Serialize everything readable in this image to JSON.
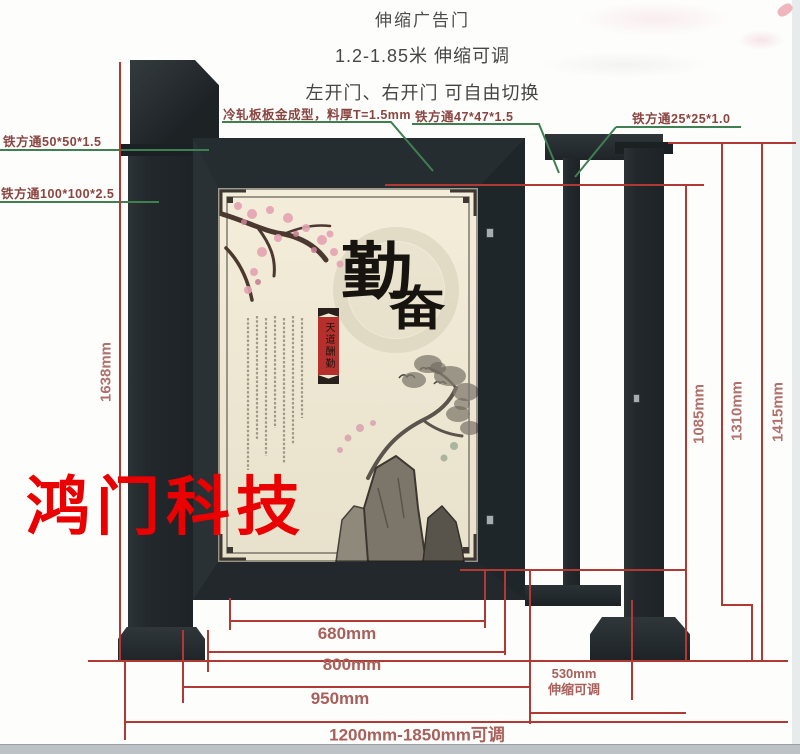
{
  "title": {
    "line1": "伸缩广告门",
    "line2": "1.2-1.85米 伸缩可调",
    "line3": "左开门、右开门 可自由切换"
  },
  "callouts": {
    "cold_rolled_sheet": "冷轧板板金成型，料厚T=1.5mm",
    "tube_50": "铁方通50*50*1.5",
    "tube_100": "铁方通100*100*2.5",
    "tube_47": "铁方通47*47*1.5",
    "tube_25": "铁方通25*25*1.0"
  },
  "dimensions": {
    "total_height": "1638mm",
    "inner_section_height": "1085mm",
    "frame_height": "1310mm",
    "pillar_height": "1415mm",
    "panel_width": "680mm",
    "door_width": "800mm",
    "door_outer_width": "950mm",
    "side_section_width": "530mm",
    "side_section_note": "伸缩可调",
    "total_width_range": "1200mm-1850mm可调"
  },
  "watermark": "鸿门科技",
  "artwork": {
    "calligraphy_top": "勤",
    "calligraphy_bottom": "奋",
    "seal_banner": "天道酬勤"
  },
  "colors": {
    "dimension_line_red": "#b03a33",
    "leader_line_green": "#3f7f52",
    "watermark_red": "#ea0000",
    "metal_dark": "#23292c",
    "panel_cream": "#efe8d5"
  }
}
